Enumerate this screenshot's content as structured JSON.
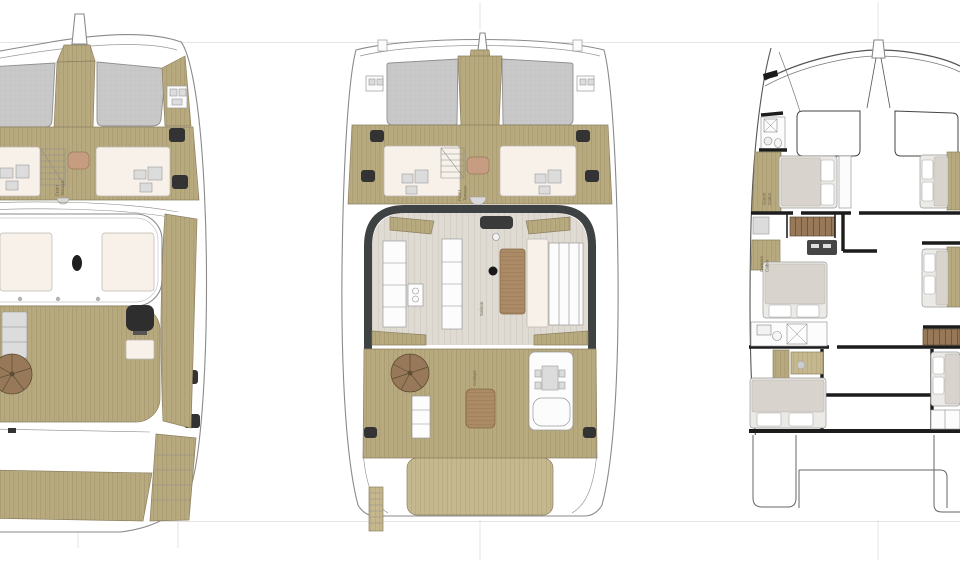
{
  "figure": {
    "subject": "catamaran-deck-plans",
    "views": [
      "flybridge",
      "main-deck",
      "lower-deck"
    ]
  },
  "views": {
    "flybridge": {
      "labels": {
        "front_terrace": [
          "Front",
          "Terrace"
        ]
      }
    },
    "main_deck": {
      "labels": {
        "front_terrace": [
          "Front",
          "Terrace"
        ],
        "saloon": "Saloon",
        "cockpit": "Cockpit"
      }
    },
    "lower_deck": {
      "labels": {
        "guest_cabin": [
          "Guest",
          "Cabin"
        ],
        "owners_cabin": [
          "Owners",
          "Cabin"
        ]
      }
    }
  },
  "palette": {
    "background": "#ffffff",
    "deck_wood": "#b9ab80",
    "deck_wood_dark": "#a3956c",
    "platform_wood": "#c6b88e",
    "trampoline": "#c9c9c9",
    "upholstery_cream": "#f7f1ea",
    "saloon_floor": "#dfdbd3",
    "table_wood": "#ab8b66",
    "terrace_table": "#c79d82",
    "stair_wood": "#97795a",
    "mattress": "#eceae6",
    "duvet": "#d8d4cd",
    "dark_fitting": "#333333",
    "bulkhead_black": "#1c1c1c",
    "hull_outline": "#8a8a8a",
    "guide_line": "#e4e4e4",
    "label_text": "#6d6046"
  }
}
